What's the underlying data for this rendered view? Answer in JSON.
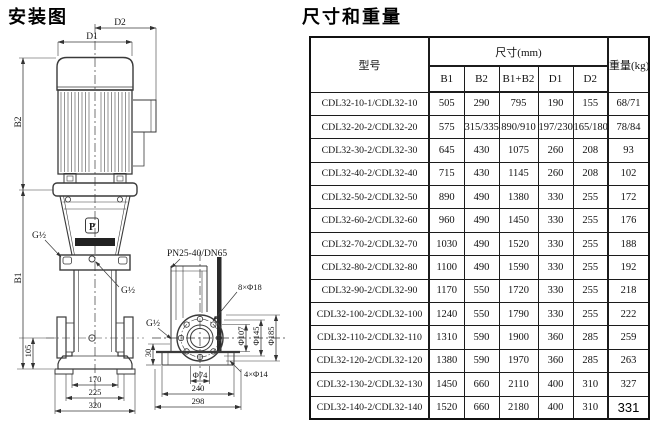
{
  "install": {
    "title": "安装图",
    "labels": {
      "d1": "D1",
      "d2": "D2",
      "b1": "B1",
      "b2": "B2",
      "g_half_top": "G½",
      "g_half_mid": "G½",
      "g_half_side": "G½",
      "logo": "P",
      "dim_105": "105",
      "dim_170": "170",
      "dim_225": "225",
      "dim_320": "320",
      "pn": "PN25-40/DN65",
      "bolt8": "8×Φ18",
      "bolt4": "4×Φ14",
      "phi107": "Φ107",
      "phi145": "Φ145",
      "phi185": "Φ185",
      "dim_30": "30",
      "phi74": "Φ74",
      "dim_240": "240",
      "dim_298": "298"
    }
  },
  "spec": {
    "title": "尺寸和重量",
    "header": {
      "model": "型号",
      "dims_group": "尺寸(mm)",
      "cols": [
        "B1",
        "B2",
        "B1+B2",
        "D1",
        "D2"
      ],
      "weight": "重量(kg)"
    },
    "rows": [
      [
        "CDL32-10-1/CDL32-10",
        "505",
        "290",
        "795",
        "190",
        "155",
        "68/71"
      ],
      [
        "CDL32-20-2/CDL32-20",
        "575",
        "315/335",
        "890/910",
        "197/230",
        "165/180",
        "78/84"
      ],
      [
        "CDL32-30-2/CDL32-30",
        "645",
        "430",
        "1075",
        "260",
        "208",
        "93"
      ],
      [
        "CDL32-40-2/CDL32-40",
        "715",
        "430",
        "1145",
        "260",
        "208",
        "102"
      ],
      [
        "CDL32-50-2/CDL32-50",
        "890",
        "490",
        "1380",
        "330",
        "255",
        "172"
      ],
      [
        "CDL32-60-2/CDL32-60",
        "960",
        "490",
        "1450",
        "330",
        "255",
        "176"
      ],
      [
        "CDL32-70-2/CDL32-70",
        "1030",
        "490",
        "1520",
        "330",
        "255",
        "188"
      ],
      [
        "CDL32-80-2/CDL32-80",
        "1100",
        "490",
        "1590",
        "330",
        "255",
        "192"
      ],
      [
        "CDL32-90-2/CDL32-90",
        "1170",
        "550",
        "1720",
        "330",
        "255",
        "218"
      ],
      [
        "CDL32-100-2/CDL32-100",
        "1240",
        "550",
        "1790",
        "330",
        "255",
        "222"
      ],
      [
        "CDL32-110-2/CDL32-110",
        "1310",
        "590",
        "1900",
        "360",
        "285",
        "259"
      ],
      [
        "CDL32-120-2/CDL32-120",
        "1380",
        "590",
        "1970",
        "360",
        "285",
        "263"
      ],
      [
        "CDL32-130-2/CDL32-130",
        "1450",
        "660",
        "2110",
        "400",
        "310",
        "327"
      ],
      [
        "CDL32-140-2/CDL32-140",
        "1520",
        "660",
        "2180",
        "400",
        "310",
        "331"
      ]
    ],
    "edited_weight_row": 13
  }
}
